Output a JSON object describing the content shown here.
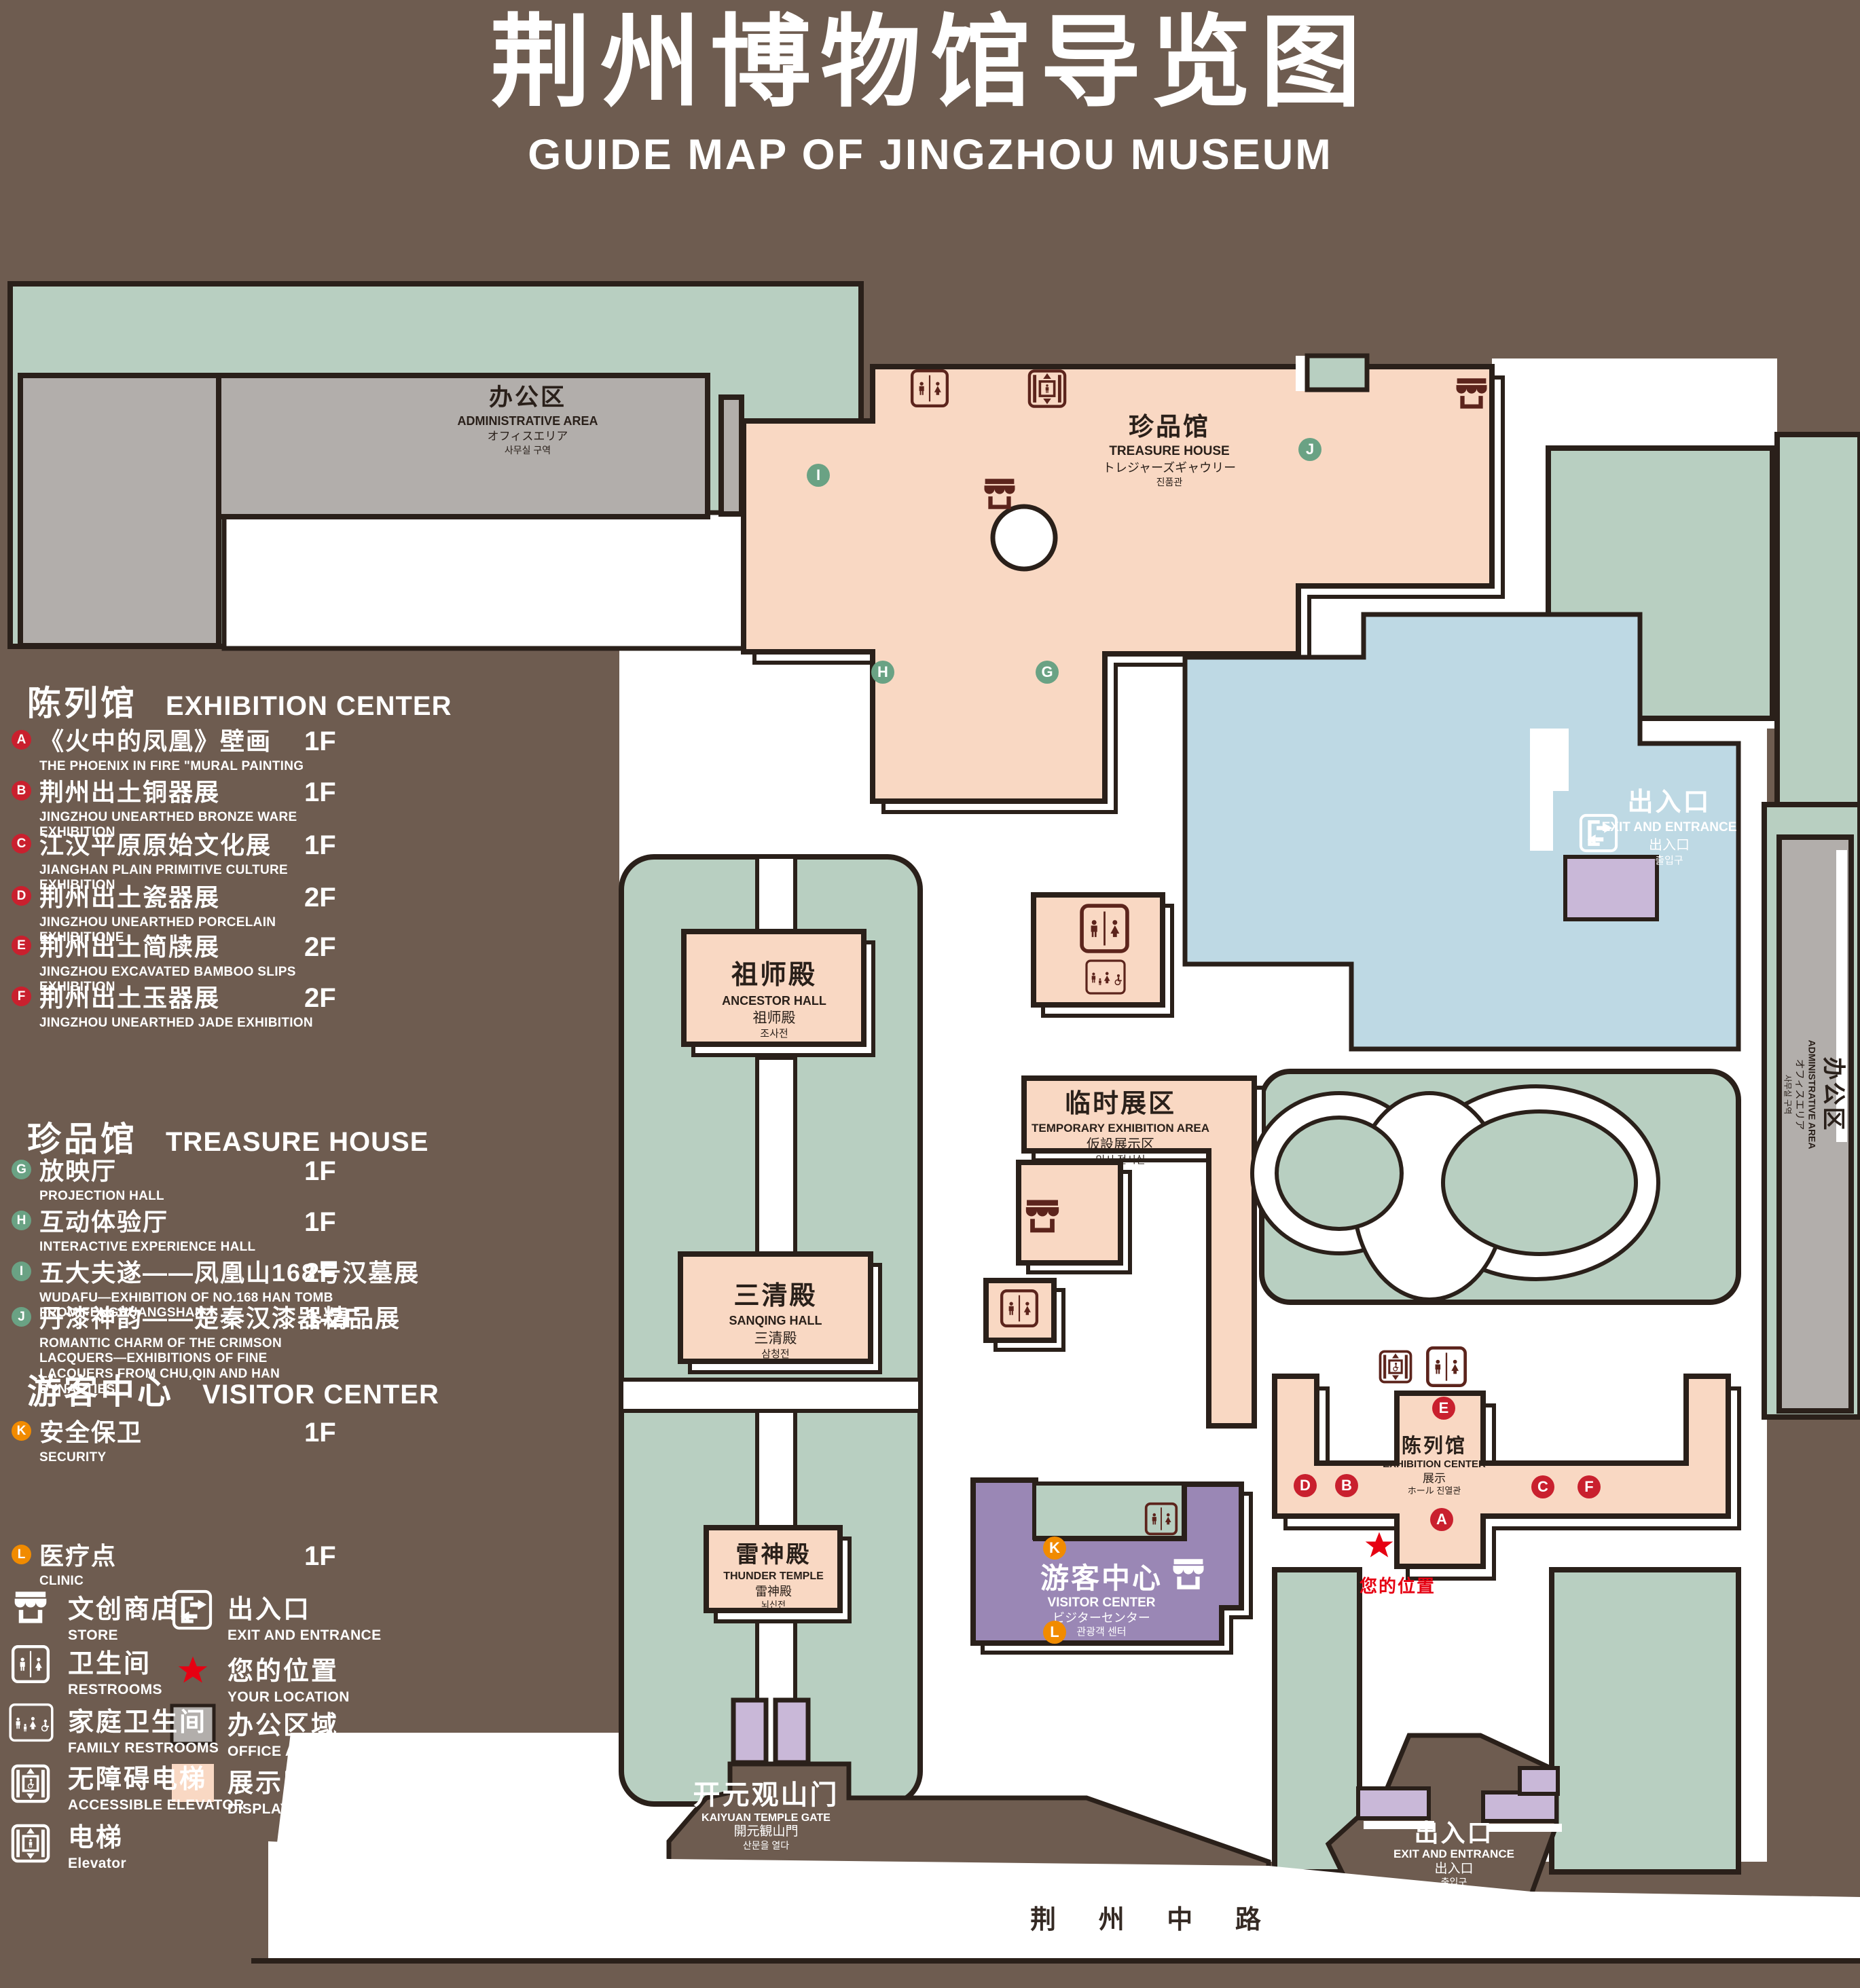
{
  "title": {
    "zh": "荆州博物馆导览图",
    "en": "GUIDE MAP OF JINGZHOU MUSEUM"
  },
  "legend": {
    "sections": [
      {
        "zh": "陈列馆",
        "en": "EXHIBITION CENTER",
        "items": [
          {
            "letter": "A",
            "zh": "《火中的凤凰》壁画",
            "en": "THE PHOENIX IN FIRE \"MURAL PAINTING",
            "floor": "1F"
          },
          {
            "letter": "B",
            "zh": "荆州出土铜器展",
            "en": "JINGZHOU UNEARTHED BRONZE WARE EXHIBITION",
            "floor": "1F"
          },
          {
            "letter": "C",
            "zh": "江汉平原原始文化展",
            "en": "JIANGHAN PLAIN PRIMITIVE CULTURE EXHIBITION",
            "floor": "1F"
          },
          {
            "letter": "D",
            "zh": "荆州出土瓷器展",
            "en": "JINGZHOU UNEARTHED PORCELAIN EXHIBITIONE",
            "floor": "2F"
          },
          {
            "letter": "E",
            "zh": "荆州出土简牍展",
            "en": "JINGZHOU EXCAVATED BAMBOO SLIPS EXHIBITION",
            "floor": "2F"
          },
          {
            "letter": "F",
            "zh": "荆州出土玉器展",
            "en": "JINGZHOU UNEARTHED JADE EXHIBITION",
            "floor": "2F"
          }
        ]
      },
      {
        "zh": "珍品馆",
        "en": "TREASURE HOUSE",
        "items": [
          {
            "letter": "G",
            "zh": "放映厅",
            "en": "PROJECTION HALL",
            "floor": "1F"
          },
          {
            "letter": "H",
            "zh": "互动体验厅",
            "en": "INTERACTIVE EXPERIENCE HALL",
            "floor": "1F"
          },
          {
            "letter": "I",
            "zh": "五大夫遂——凤凰山168号汉墓展",
            "en": "WUDAFU—EXHIBITION OF NO.168 HAN TOMB FROM FENGHUANGSHAN",
            "floor": "2F"
          },
          {
            "letter": "J",
            "zh": "丹漆神韵——楚秦汉漆器精品展",
            "en": "ROMANTIC CHARM OF THE CRIMSON LACQUERS—EXHIBITIONS OF FINE LACQUERS FROM CHU,QIN AND HAN DYNASTIES",
            "floor": "1-2F"
          }
        ]
      },
      {
        "zh": "游客中心",
        "en": "VISITOR CENTER",
        "items": [
          {
            "letter": "K",
            "zh": "安全保卫",
            "en": "SECURITY",
            "floor": "1F"
          },
          {
            "letter": "L",
            "zh": "医疗点",
            "en": "CLINIC",
            "floor": "1F"
          }
        ]
      }
    ],
    "symbols": [
      {
        "icon": "store-icon",
        "zh": "文创商店",
        "en": "STORE"
      },
      {
        "icon": "restrooms-icon",
        "zh": "卫生间",
        "en": "RESTROOMS"
      },
      {
        "icon": "family-restrooms-icon",
        "zh": "家庭卫生间",
        "en": "FAMILY RESTROOMS"
      },
      {
        "icon": "accessible-elevator-icon",
        "zh": "无障碍电梯",
        "en": "ACCESSIBLE ELEVATOR"
      },
      {
        "icon": "elevator-icon",
        "zh": "电梯",
        "en": "Elevator"
      },
      {
        "icon": "exit-icon",
        "zh": "出入口",
        "en": "EXIT AND ENTRANCE"
      },
      {
        "icon": "location-star-icon",
        "zh": "您的位置",
        "en": "YOUR LOCATION"
      },
      {
        "icon": "office-area-swatch",
        "zh": "办公区域",
        "en": "OFFICE AREA"
      },
      {
        "icon": "display-area-swatch",
        "zh": "展示区域",
        "en": "DISPLAY AREA"
      }
    ]
  },
  "map": {
    "buildings": {
      "admin_top": [
        "办公区",
        "ADMINISTRATIVE AREA",
        "オフィスエリア",
        "사무실 구역"
      ],
      "admin_right": [
        "办公区",
        "ADMINISTRATIVE AREA",
        "オフィスエリア",
        "사무실 구역"
      ],
      "treasure": [
        "珍品馆",
        "TREASURE HOUSE",
        "トレジャーズギャウリー",
        "진품관"
      ],
      "ancestor": [
        "祖师殿",
        "ANCESTOR HALL",
        "祖师殿",
        "조사전"
      ],
      "temporary": [
        "临时展区",
        "TEMPORARY EXHIBITION AREA",
        "仮設展示区",
        "임시 전시실"
      ],
      "sanqing": [
        "三清殿",
        "SANQING HALL",
        "三清殿",
        "삼청전"
      ],
      "thunder": [
        "雷神殿",
        "THUNDER TEMPLE",
        "雷神殿",
        "뇌신전"
      ],
      "visitor": [
        "游客中心",
        "VISITOR CENTER",
        "ビジターセンター",
        "관광객 센터"
      ],
      "exhibition": [
        "陈列馆",
        "EXHIBITION CENTER",
        "展示",
        "ホール 진열관"
      ]
    },
    "exit": [
      "出入口",
      "EXIT AND ENTRANCE",
      "出入口",
      "출입구"
    ],
    "gate": [
      "开元观山门",
      "KAIYUAN TEMPLE GATE",
      "開元観山門",
      "산문을 열다"
    ],
    "road": "荆 州 中 路",
    "your_location": "您的位置",
    "badges": {
      "A": "A",
      "B": "B",
      "C": "C",
      "D": "D",
      "E": "E",
      "F": "F",
      "G": "G",
      "H": "H",
      "I": "I",
      "J": "J",
      "K": "K",
      "L": "L"
    }
  },
  "colors": {
    "background": "#6e5c50",
    "display_area": "#f9d8c3",
    "office_area": "#b2aeab",
    "landscape": "#b8cfc1",
    "visitor_center": "#9a87b5",
    "pond": "#bed9e4",
    "badge_red": "#c9202e",
    "badge_green": "#6aa284",
    "badge_orange": "#f18b00",
    "icon_maroon": "#5c241c",
    "location_red": "#e60012"
  }
}
